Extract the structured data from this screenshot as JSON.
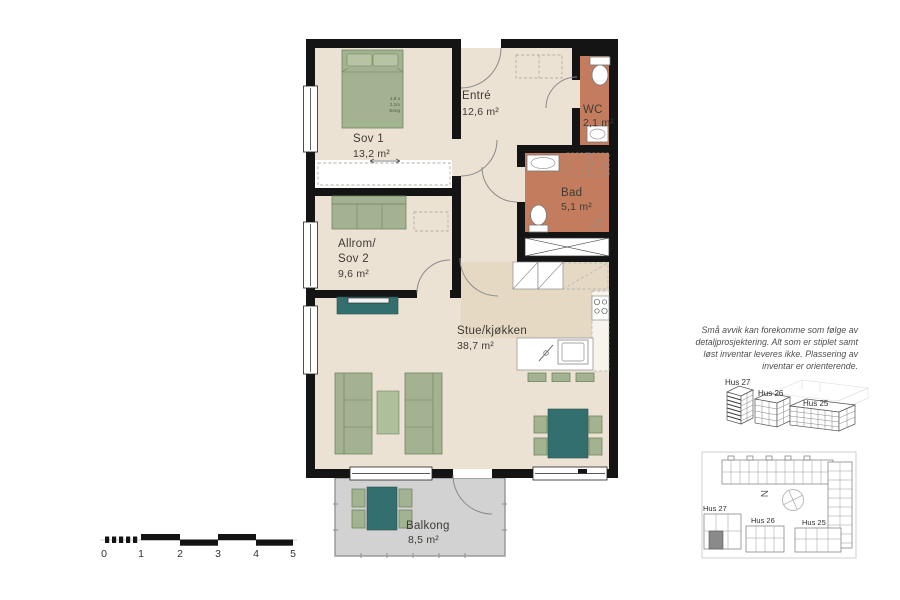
{
  "rooms": [
    {
      "name": "Sov 1",
      "area": "13,2 m²"
    },
    {
      "name": "Entré",
      "area": "12,6 m²"
    },
    {
      "name": "WC",
      "area": "2,1 m²"
    },
    {
      "name": "Bad",
      "area": "5,1 m²"
    },
    {
      "name": "Allrom/",
      "name2": "Sov 2",
      "area": "9,6 m²"
    },
    {
      "name": "Stue/kjøkken",
      "area": "38,7 m²"
    },
    {
      "name": "Balkong",
      "area": "8,5 m²"
    }
  ],
  "bed_note": {
    "l1": "1,8 x",
    "l2": "2,1m",
    "l3": "Seng"
  },
  "disclaimer": {
    "l1": "Små avvik kan forekomme som følge av",
    "l2": "detaljprosjektering. Alt som er stiplet samt",
    "l3": "løst inventar leveres ikke. Plassering av",
    "l4": "inventar er orienterende."
  },
  "overview_3d": {
    "labels": [
      "Hus 27",
      "Hus 26",
      "Hus 25"
    ]
  },
  "site_plan": {
    "hus27": "Hus 27",
    "hus26": "Hus 26",
    "hus25": "Hus 25",
    "north": "N"
  },
  "scale_bar": {
    "labels": [
      "0",
      "1",
      "2",
      "3",
      "4",
      "5"
    ]
  },
  "colors": {
    "wall": "#141414",
    "floor": "#ece2d4",
    "kitchen_floor": "#e5d9c4",
    "wet_room_floor": "#c37d5e",
    "furniture_green": "#a3b391",
    "furniture_teal": "#326f6e",
    "balcony_floor": "#d2d2d2"
  }
}
